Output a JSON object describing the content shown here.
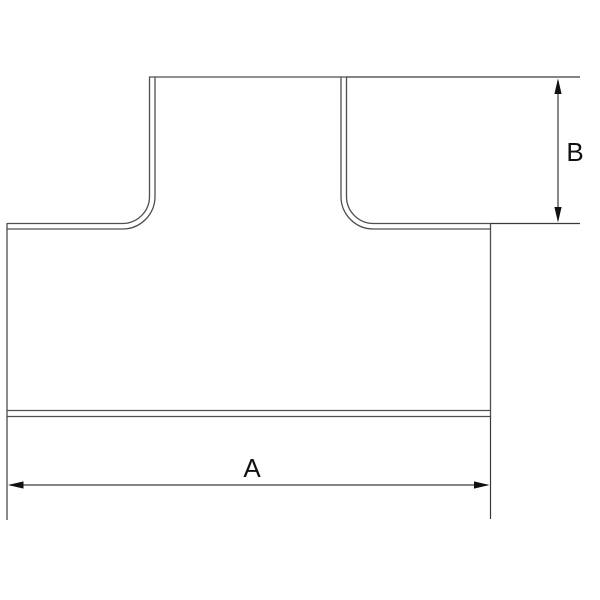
{
  "drawing": {
    "kind": "technical-dimension-drawing",
    "subject": "tee-fitting-outline",
    "dimension_labels": {
      "a": "A",
      "b": "B"
    },
    "colors": {
      "background": "#ffffff",
      "outline": "#4f4f4f",
      "dimension_line": "#3a3a3a",
      "arrowhead": "#111111",
      "label_text": "#111111"
    }
  }
}
